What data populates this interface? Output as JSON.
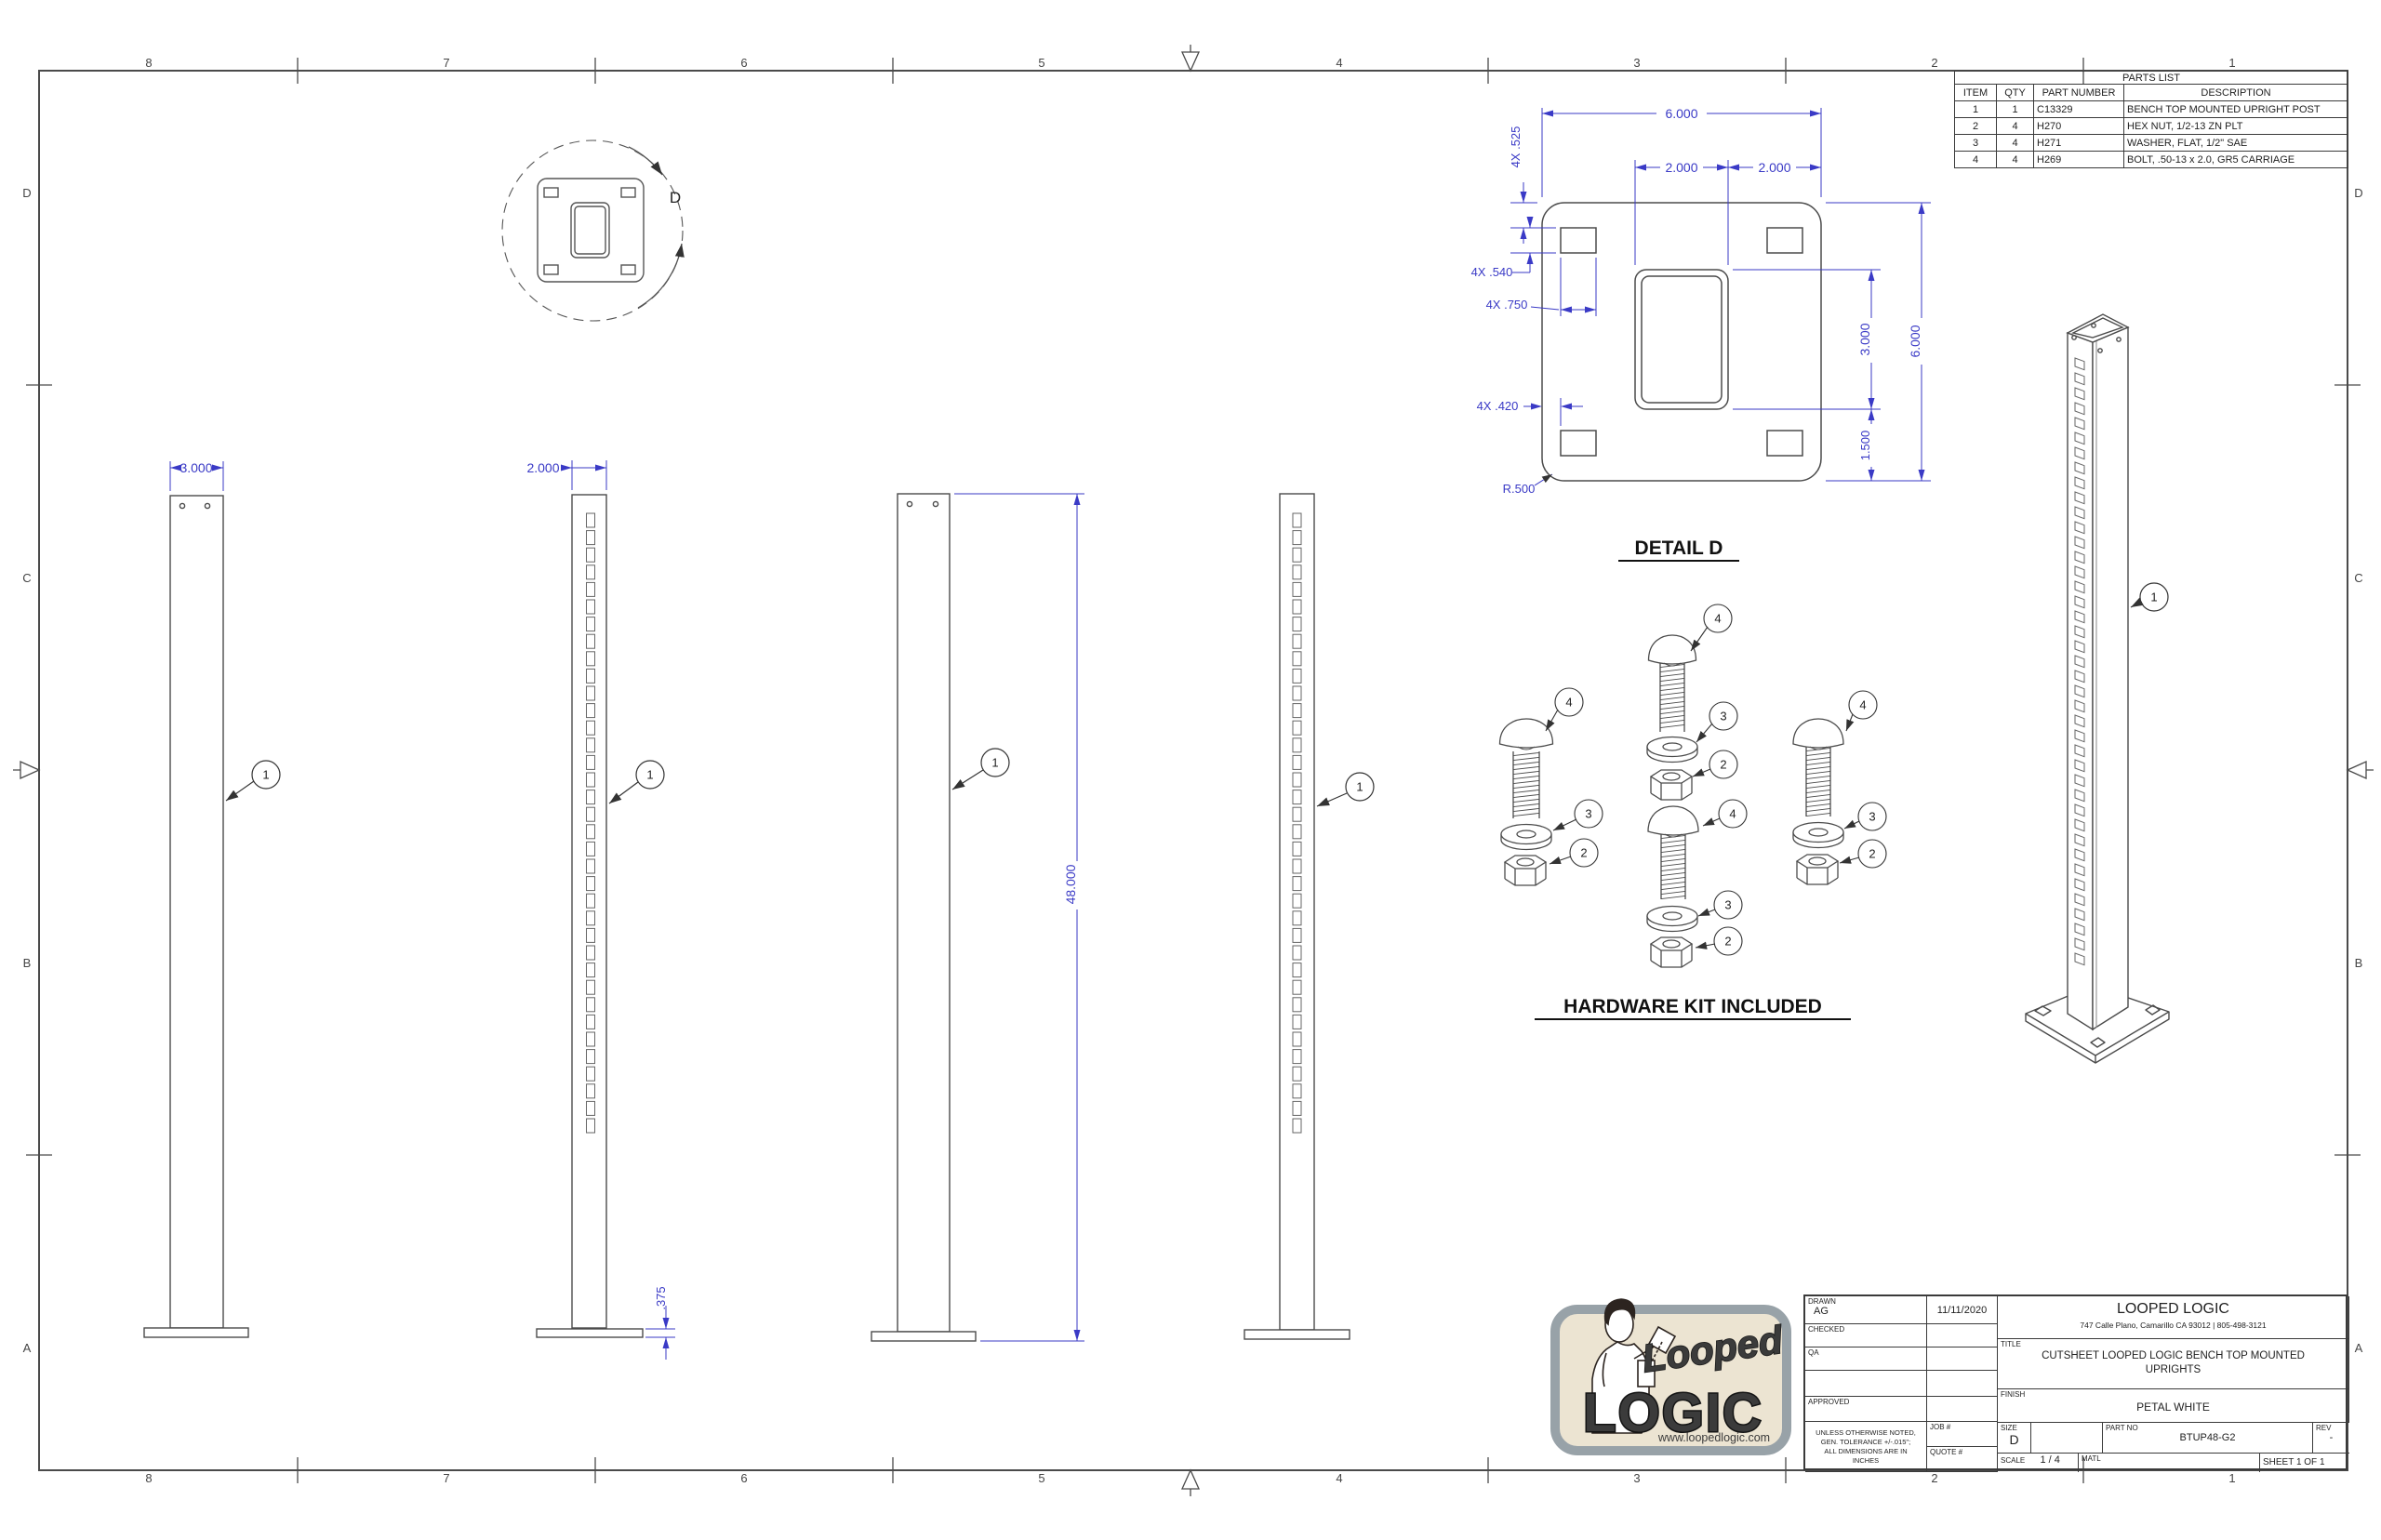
{
  "zones": {
    "top": [
      "8",
      "7",
      "6",
      "5",
      "4",
      "3",
      "2",
      "1"
    ],
    "bottom": [
      "8",
      "7",
      "6",
      "5",
      "4",
      "3",
      "2",
      "1"
    ],
    "left": [
      "D",
      "C",
      "B",
      "A"
    ],
    "right": [
      "D",
      "C",
      "B",
      "A"
    ]
  },
  "parts_list": {
    "title": "PARTS LIST",
    "columns": [
      "ITEM",
      "QTY",
      "PART NUMBER",
      "DESCRIPTION"
    ],
    "rows": [
      [
        "1",
        "1",
        "C13329",
        "BENCH TOP MOUNTED UPRIGHT POST"
      ],
      [
        "2",
        "4",
        "H270",
        "HEX NUT, 1/2-13 ZN PLT"
      ],
      [
        "3",
        "4",
        "H271",
        "WASHER, FLAT, 1/2\" SAE"
      ],
      [
        "4",
        "4",
        "H269",
        "BOLT, .50-13 x 2.0, GR5 CARRIAGE"
      ]
    ]
  },
  "view_titles": {
    "detail_d": "DETAIL  D",
    "hardware": "HARDWARE KIT INCLUDED",
    "detail_label": "D"
  },
  "balloons": {
    "post": "1",
    "nut": "2",
    "washer": "3",
    "bolt": "4"
  },
  "dims": {
    "post_front_width": "3.000",
    "post_side_width": "2.000",
    "post_height": "48.000",
    "base_thickness": ".375",
    "plate_width": "6.000",
    "tube_width": "2.000",
    "tube_to_edge": "2.000",
    "plate_height": "6.000",
    "tube_height": "3.000",
    "tube_to_bottom": "1.500",
    "slot_top_offset": "4X .525",
    "slot_height": "4X .540",
    "slot_width": "4X .750",
    "slot_side_offset": "4X .420",
    "corner_radius": "R.500"
  },
  "title_block": {
    "labels": {
      "drawn": "DRAWN",
      "checked": "CHECKED",
      "qa": "QA",
      "approved": "APPROVED",
      "job": "JOB #",
      "quote": "QUOTE #",
      "title": "TITLE",
      "finish": "FINISH",
      "size": "SIZE",
      "part_no": "PART NO",
      "rev": "REV",
      "scale": "SCALE",
      "matl": "MATL"
    },
    "values": {
      "drawn_by": "AG",
      "drawn_date": "11/11/2020",
      "company": "LOOPED LOGIC",
      "address": "747 Calle Plano, Camarillo CA 93012 | 805-498-3121",
      "title_line1": "CUTSHEET LOOPED LOGIC BENCH TOP MOUNTED",
      "title_line2": "UPRIGHTS",
      "finish": "PETAL WHITE",
      "size": "D",
      "part_no": "BTUP48-G2",
      "rev": "-",
      "scale": "1 / 4",
      "sheet": "SHEET 1  OF 1"
    },
    "tolerance_lines": [
      "UNLESS OTHERWISE NOTED,",
      "GEN. TOLERANCE +/-.015\";",
      "ALL DIMENSIONS ARE IN",
      "INCHES"
    ]
  },
  "logo": {
    "script": "Looped",
    "word": "LOGIC",
    "url": "www.loopedlogic.com"
  }
}
